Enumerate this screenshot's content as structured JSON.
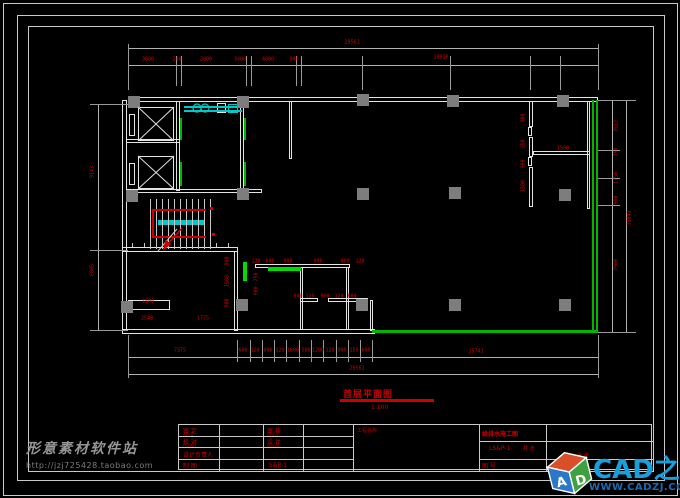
{
  "watermark": {
    "site": "形意素材软件站",
    "url": "http://jzj725428.taobao.com"
  },
  "logo": {
    "brand": "CAD之家",
    "site": "WWW.CADZJ.COM",
    "cube_left": "A",
    "cube_right": "D"
  },
  "drawing_title": {
    "text": "首层平面图",
    "scale": "1:100"
  },
  "title_block": {
    "appd_label": "审 定",
    "appd_sub": "APPD.",
    "check_label": "审 核",
    "check_sub": "CHKD.",
    "proof_label": "校 对",
    "proof_sub": "PROOF",
    "design_label": "设 计",
    "design_sub": "DSGN.",
    "chief_label": "设计负责人",
    "draft_label": "制 图",
    "draft_sub": "DRAWN",
    "drawing_no": "S&P-1",
    "project_label": "工程名称",
    "project_name": "给排水施工图",
    "sheet_no": "LS&P-1",
    "sheet_label": "图 号",
    "pages_note1": "共 张",
    "pages_note2": "第 张"
  },
  "dim_labels": [
    {
      "t": "29561",
      "x": 352,
      "y": 43
    },
    {
      "t": "3600",
      "x": 148,
      "y": 60
    },
    {
      "t": "240",
      "x": 177,
      "y": 60
    },
    {
      "t": "2800",
      "x": 206,
      "y": 60
    },
    {
      "t": "3400",
      "x": 240,
      "y": 60
    },
    {
      "t": "4000",
      "x": 268,
      "y": 60
    },
    {
      "t": "900",
      "x": 294,
      "y": 60
    },
    {
      "t": "18920",
      "x": 441,
      "y": 58
    },
    {
      "t": "7375",
      "x": 180,
      "y": 351
    },
    {
      "t": "600",
      "x": 243,
      "y": 351
    },
    {
      "t": "120",
      "x": 255,
      "y": 351
    },
    {
      "t": "900",
      "x": 268,
      "y": 351
    },
    {
      "t": "120",
      "x": 280,
      "y": 351
    },
    {
      "t": "1680",
      "x": 293,
      "y": 351
    },
    {
      "t": "500",
      "x": 306,
      "y": 351
    },
    {
      "t": "1200",
      "x": 318,
      "y": 351
    },
    {
      "t": "120",
      "x": 330,
      "y": 351
    },
    {
      "t": "900",
      "x": 342,
      "y": 351
    },
    {
      "t": "150",
      "x": 354,
      "y": 351
    },
    {
      "t": "600",
      "x": 366,
      "y": 351
    },
    {
      "t": "15743",
      "x": 476,
      "y": 352
    },
    {
      "t": "29561",
      "x": 357,
      "y": 369
    },
    {
      "t": "9143",
      "x": 93,
      "y": 172,
      "r": 1
    },
    {
      "t": "6805",
      "x": 93,
      "y": 270,
      "r": 1
    },
    {
      "t": "3512",
      "x": 617,
      "y": 126,
      "r": 1
    },
    {
      "t": "750",
      "x": 617,
      "y": 152,
      "r": 1
    },
    {
      "t": "1750",
      "x": 617,
      "y": 178,
      "r": 1
    },
    {
      "t": "900",
      "x": 617,
      "y": 200,
      "r": 1
    },
    {
      "t": "7900",
      "x": 617,
      "y": 265,
      "r": 1
    },
    {
      "t": "16043",
      "x": 630,
      "y": 218,
      "r": 1
    },
    {
      "t": "900",
      "x": 524,
      "y": 118,
      "r": 1
    },
    {
      "t": "150",
      "x": 524,
      "y": 144,
      "r": 1
    },
    {
      "t": "900",
      "x": 524,
      "y": 164,
      "r": 1
    },
    {
      "t": "1500",
      "x": 524,
      "y": 186,
      "r": 1
    },
    {
      "t": "1500",
      "x": 563,
      "y": 149
    },
    {
      "t": "1500",
      "x": 148,
      "y": 302
    },
    {
      "t": "2540",
      "x": 147,
      "y": 319
    },
    {
      "t": "1775",
      "x": 203,
      "y": 319
    },
    {
      "t": "900",
      "x": 228,
      "y": 261,
      "r": 1
    },
    {
      "t": "1500",
      "x": 228,
      "y": 281,
      "r": 1
    },
    {
      "t": "900",
      "x": 228,
      "y": 303,
      "r": 1
    },
    {
      "t": "750",
      "x": 257,
      "y": 277,
      "r": 1
    },
    {
      "t": "900",
      "x": 257,
      "y": 291,
      "r": 1
    },
    {
      "t": "120",
      "x": 256,
      "y": 262
    },
    {
      "t": "600",
      "x": 270,
      "y": 262
    },
    {
      "t": "900",
      "x": 288,
      "y": 262
    },
    {
      "t": "900",
      "x": 318,
      "y": 262
    },
    {
      "t": "600",
      "x": 345,
      "y": 262
    },
    {
      "t": "120",
      "x": 360,
      "y": 262
    },
    {
      "t": "600",
      "x": 298,
      "y": 297
    },
    {
      "t": "120",
      "x": 310,
      "y": 297
    },
    {
      "t": "900",
      "x": 325,
      "y": 297
    },
    {
      "t": "120",
      "x": 339,
      "y": 297
    },
    {
      "t": "600",
      "x": 352,
      "y": 297
    }
  ]
}
